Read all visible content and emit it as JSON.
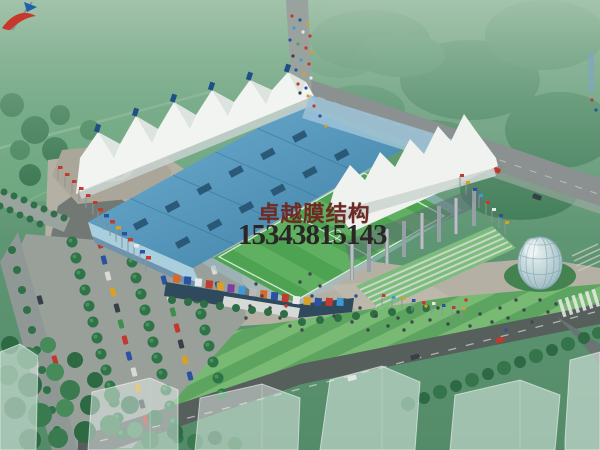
{
  "window": {
    "width": 600,
    "height": 450
  },
  "subject": {
    "type": "architectural rendering",
    "view": "aerial perspective",
    "description": "Stadium with white tensile membrane roofs, blue grandstand roof, football pitch, plaza with crowds, tree-lined parking lot, glass dome pavilion and surrounding roads"
  },
  "watermark": {
    "company_name": "卓越膜结构",
    "phone_number": "15343815143",
    "company_color": "#6e2a24",
    "phone_color": "#2b2526",
    "logo": "sailboat-logo"
  },
  "palette": {
    "haze_green": "#7fae8f",
    "field_green": "#6aa67d",
    "tree_green": "#2d6a44",
    "pitch_green": "#4ea352",
    "roof_blue": "#4f93b8",
    "membrane_white": "#f1f4f0",
    "plaza_gray": "#b5b0a4",
    "road_dark": "#565f5c",
    "road_light": "#8a9190",
    "water_blue": "#4694d2",
    "dome_glass": "#b9cdd2",
    "flag_red": "#c23b2e",
    "flag_blue": "#2a52a0",
    "flag_yellow": "#d8a024"
  }
}
